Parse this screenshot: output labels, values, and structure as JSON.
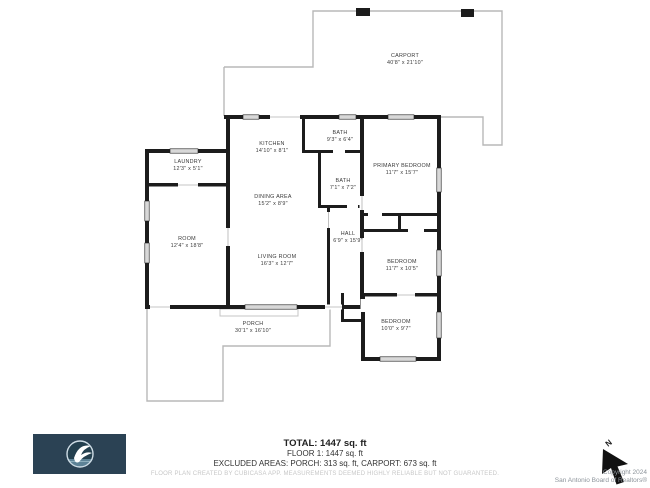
{
  "plan": {
    "rooms": [
      {
        "name": "CARPORT",
        "dims": "40'8\" x 21'10\""
      },
      {
        "name": "LAUNDRY",
        "dims": "12'3\" x 5'1\""
      },
      {
        "name": "KITCHEN",
        "dims": "14'10\" x 8'1\""
      },
      {
        "name": "BATH",
        "dims": "9'3\" x 6'4\""
      },
      {
        "name": "BATH",
        "dims": "7'1\" x 7'2\""
      },
      {
        "name": "PRIMARY BEDROOM",
        "dims": "11'7\" x 15'7\""
      },
      {
        "name": "DINING AREA",
        "dims": "15'2\" x 8'9\""
      },
      {
        "name": "HALL",
        "dims": "6'9\" x 15'9\""
      },
      {
        "name": "ROOM",
        "dims": "12'4\" x 18'8\""
      },
      {
        "name": "LIVING ROOM",
        "dims": "16'3\" x 12'7\""
      },
      {
        "name": "BEDROOM",
        "dims": "11'7\" x 10'5\""
      },
      {
        "name": "BEDROOM",
        "dims": "10'0\" x 9'7\""
      },
      {
        "name": "PORCH",
        "dims": "30'1\" x 16'10\""
      }
    ]
  },
  "footer": {
    "total": "TOTAL: 1447 sq. ft",
    "floor": "FLOOR 1: 1447 sq. ft",
    "excluded": "EXCLUDED AREAS: PORCH: 313 sq. ft, CARPORT: 673 sq. ft",
    "disclaimer": "FLOOR PLAN CREATED BY CUBICASA APP. MEASUREMENTS DEEMED HIGHLY RELIABLE BUT NOT GUARANTEED."
  },
  "copyright": {
    "line1": "Copyright 2024",
    "line2": "San Antonio Board of Realtors®"
  },
  "north_label": "N",
  "colors": {
    "wall": "#1c1c1c",
    "window_fill": "#d8d8d8",
    "thin_outline": "#b8b8b8",
    "logo_background": "#2b4254",
    "logo_water": "#5d8296"
  }
}
